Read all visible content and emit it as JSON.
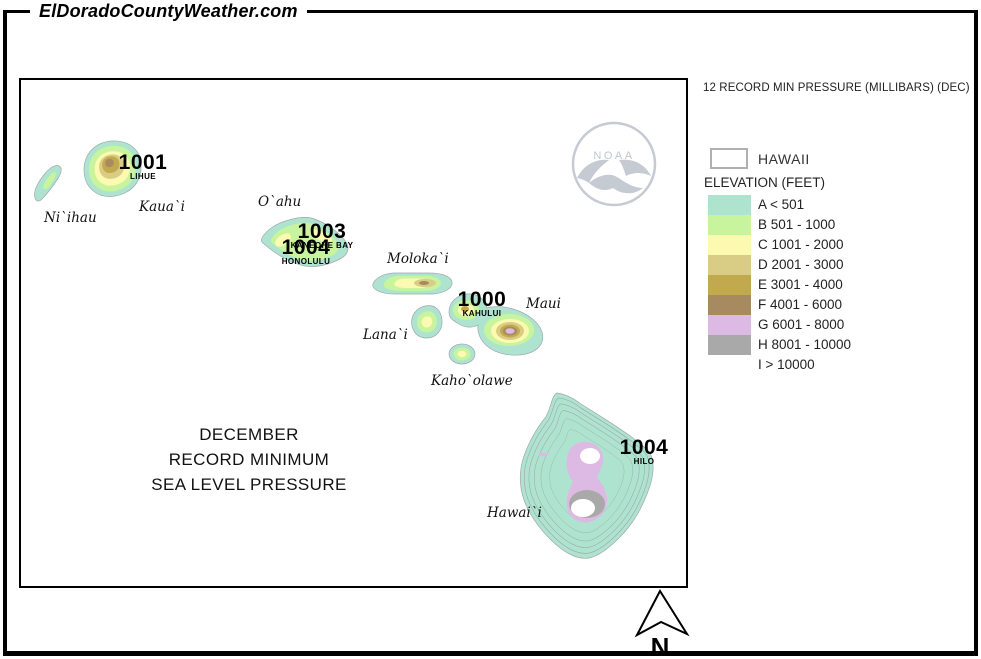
{
  "header": {
    "site_title": "ElDoradoCountyWeather.com"
  },
  "legend": {
    "title": "12 RECORD MIN PRESSURE (MILLIBARS) (DEC)",
    "region_label": "HAWAII",
    "elevation_label": "ELEVATION (FEET)",
    "classes": [
      {
        "label": "A < 501",
        "color": "#aee4cf"
      },
      {
        "label": "B 501 - 1000",
        "color": "#c8f49e"
      },
      {
        "label": "C 1001 - 2000",
        "color": "#fbfab0"
      },
      {
        "label": "D 2001 - 3000",
        "color": "#d9cc85"
      },
      {
        "label": "E 3001 - 4000",
        "color": "#c2a94d"
      },
      {
        "label": "F 4001 - 6000",
        "color": "#a88a60"
      },
      {
        "label": "G 6001 - 8000",
        "color": "#dcbae3"
      },
      {
        "label": "H 8001 - 10000",
        "color": "#a9a9a9"
      },
      {
        "label": "I > 10000",
        "color": "#ffffff"
      }
    ]
  },
  "map": {
    "title_lines": [
      "DECEMBER",
      "RECORD MINIMUM",
      "SEA LEVEL PRESSURE"
    ],
    "islands": [
      {
        "label": "Ni`ihau"
      },
      {
        "label": "Kaua`i"
      },
      {
        "label": "O`ahu"
      },
      {
        "label": "Moloka`i"
      },
      {
        "label": "Lana`i"
      },
      {
        "label": "Maui"
      },
      {
        "label": "Kaho`olawe"
      },
      {
        "label": "Hawai`i"
      }
    ],
    "stations": [
      {
        "pressure": "1001",
        "station": "LIHUE"
      },
      {
        "pressure": "1003",
        "station": "KANEOHE BAY"
      },
      {
        "pressure": "1004",
        "station": "HONOLULU"
      },
      {
        "pressure": "1000",
        "station": "KAHULUI"
      },
      {
        "pressure": "1004",
        "station": "HILO"
      }
    ],
    "noaa_label": "NOAA",
    "north_label": "N"
  }
}
